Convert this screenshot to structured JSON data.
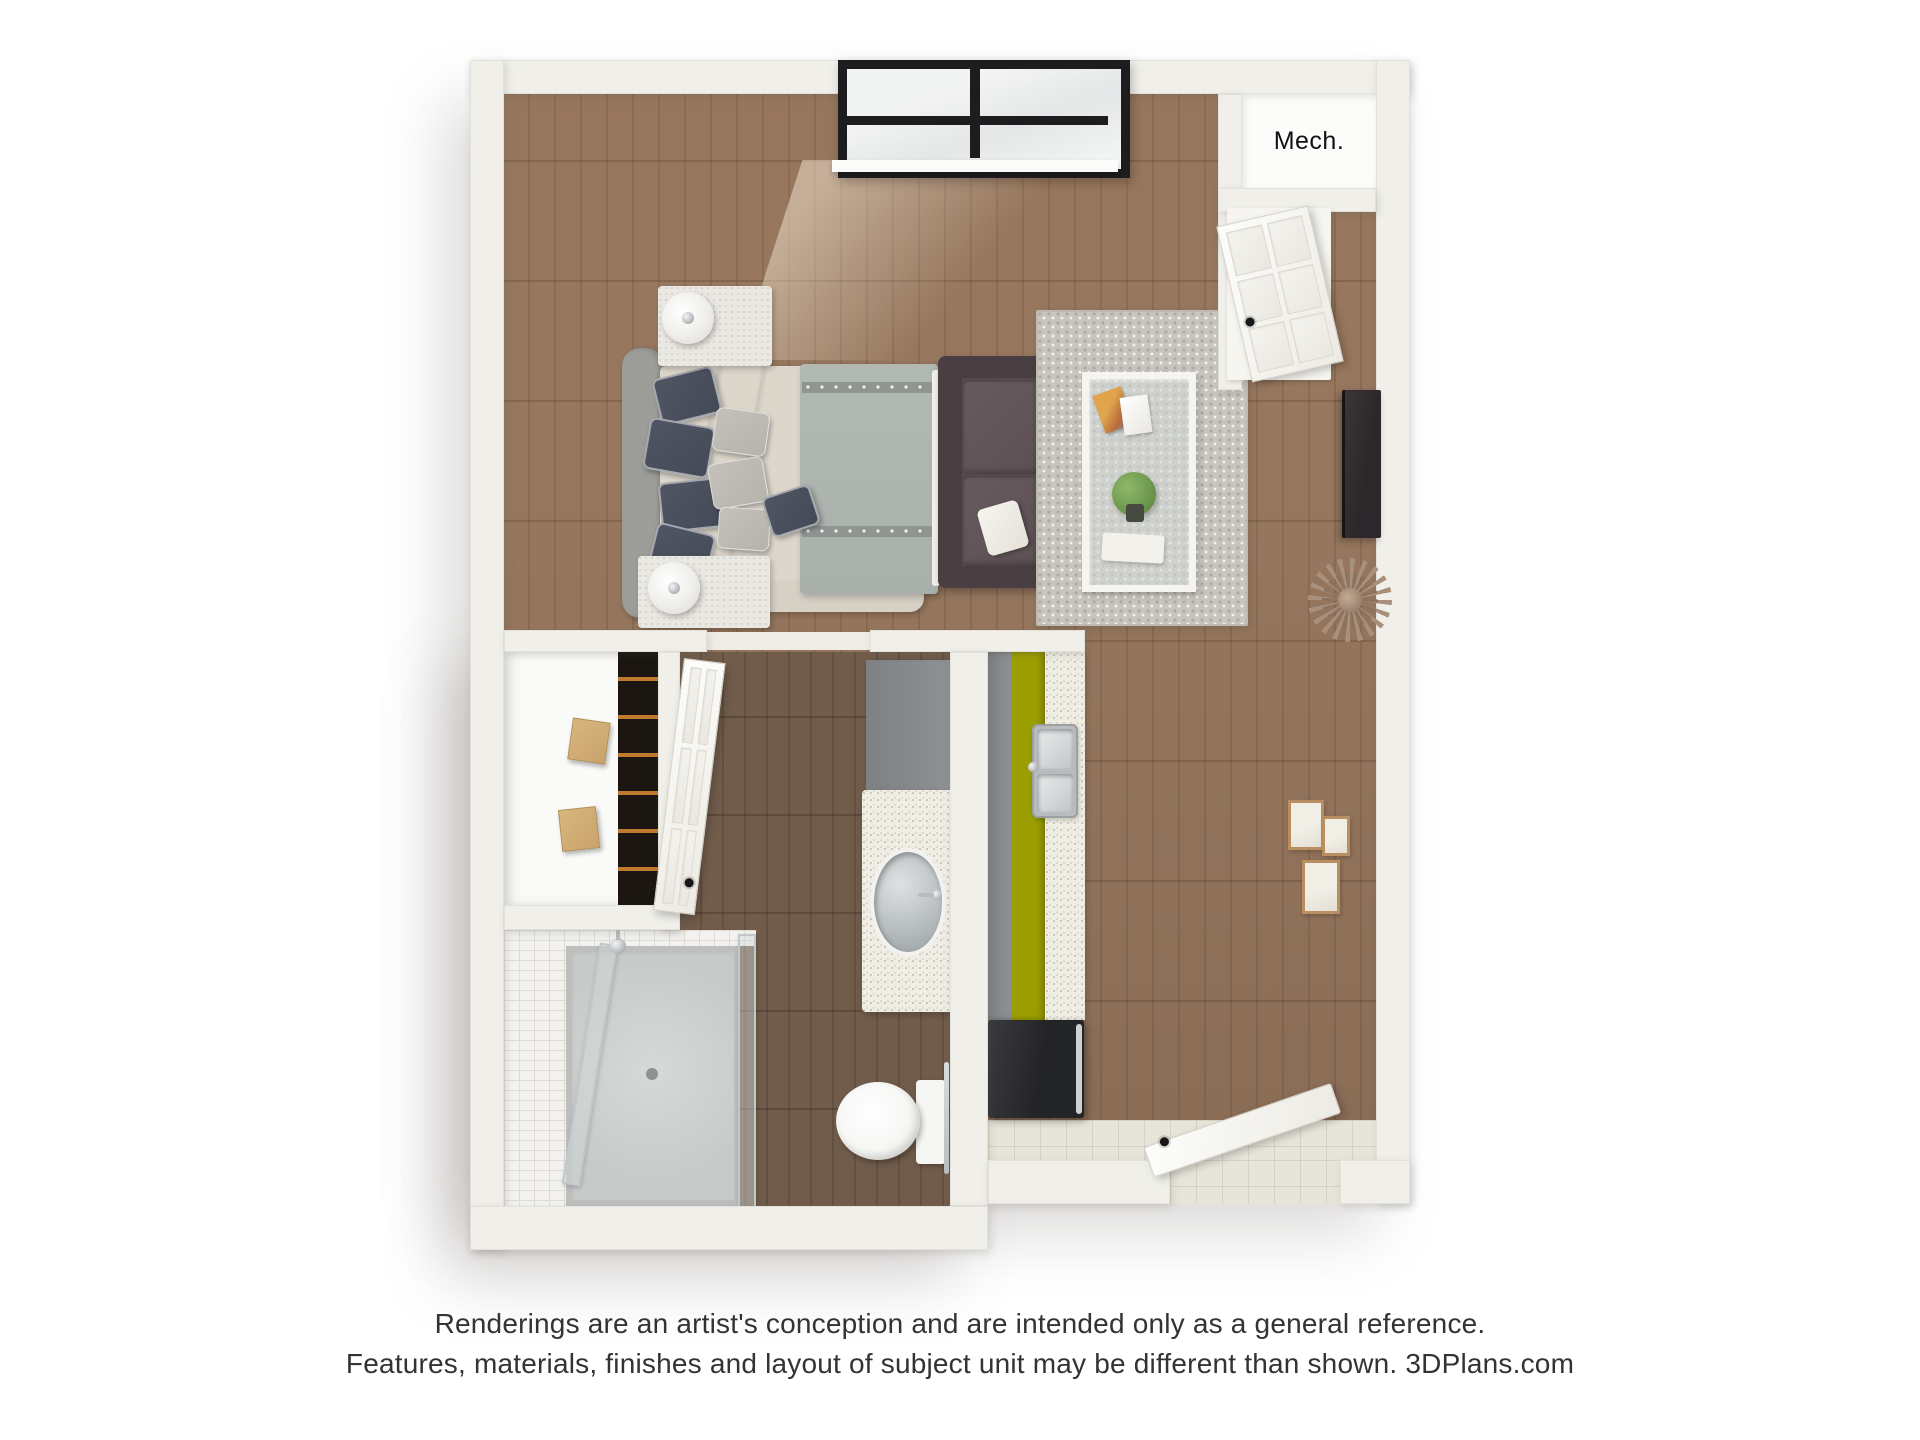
{
  "floor_plan": {
    "mech_label": "Mech."
  },
  "disclaimer": {
    "line1": "Renderings are an artist's conception and are intended only as a general reference.",
    "line2": "Features, materials, finishes and layout of subject unit may be different than shown. 3DPlans.com"
  },
  "colors": {
    "wall": "#f0efe9",
    "wall_face": "#e4e2db",
    "wall_edge": "#d9d6cd",
    "wood_a": "#9a7a61",
    "wood_b": "#8d6e56",
    "wood_dark_a": "#715c4b",
    "wood_dark_b": "#645040",
    "tile": "#e7e5da",
    "floor_white": "#fafaf8",
    "rug": "#c8c5bf",
    "rug_dot": "#aeaba4",
    "sofa": "#55484c",
    "sofa_dark": "#493e42",
    "cushion": "#5d5054",
    "sheet": "#dcd6cb",
    "duvet": "#a9afab",
    "duvet_band": "#8f9591",
    "headboard": "#9c9c98",
    "pillow_navy": "#454a57",
    "pillow_gray": "#b6b3ad",
    "nightstand": "#eae8e2",
    "counter": "#efede4",
    "cabinet": "#8e9193",
    "fridge": "#232426",
    "box_tan": "#c9a36b",
    "shelf_dark": "#1b1611",
    "rod": "#c07a2e",
    "frame_black": "#1d1d1f",
    "glass": "#ecedee",
    "door": "#fbfaf7",
    "chrome": "#b9bcbe",
    "plant": "#6f9a4f",
    "pot": "#45493f",
    "frame_tan": "#b98f62",
    "tv": "#2b272a",
    "sun1": "#a8907c",
    "sun2": "#8a7260",
    "toilet": "#f6f6f4",
    "pan": "#c7cac9",
    "tile_white": "#f3f2ee",
    "tile_line": "#dddcd4",
    "text": "#333333"
  }
}
